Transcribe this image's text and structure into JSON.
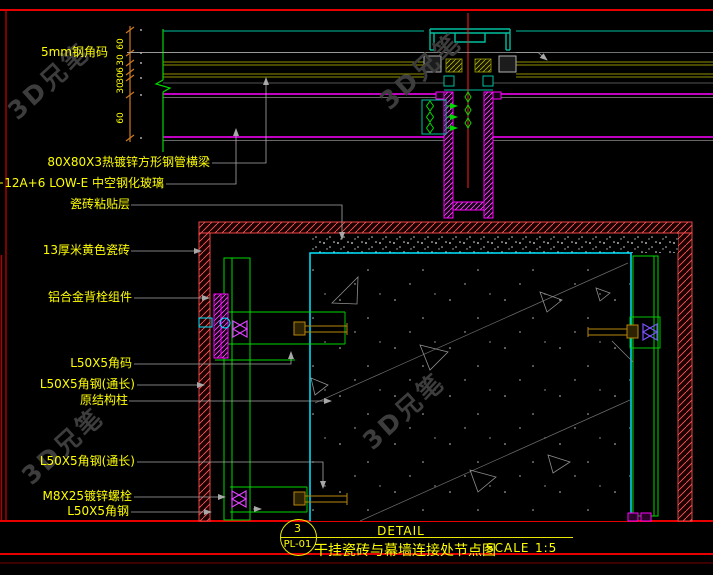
{
  "drawing": {
    "type": "CAD detail drawing",
    "labels": [
      {
        "text": "5mm钢角码"
      },
      {
        "text": "80X80X3热镀锌方形钢管横梁"
      },
      {
        "text": "6+12A+6 LOW-E 中空钢化玻璃"
      },
      {
        "text": "瓷砖粘贴层"
      },
      {
        "text": "13厚米黄色瓷砖"
      },
      {
        "text": "铝合金背栓组件"
      },
      {
        "text": "L50X5角码"
      },
      {
        "text": "L50X5角钢(通长)"
      },
      {
        "text": "原结构柱"
      },
      {
        "text": "L50X5角钢(通长)"
      },
      {
        "text": "M8X25镀锌螺栓"
      },
      {
        "text": "L50X5角钢"
      }
    ],
    "dimensions": {
      "values": [
        "60",
        "30",
        "6",
        "30",
        "30",
        "60"
      ]
    }
  },
  "title_block": {
    "detail_label": "DETAIL",
    "bubble_number": "3",
    "bubble_code": "PL-01",
    "title": "干挂瓷砖与幕墙连接处节点图",
    "scale_label": "SCALE",
    "scale_value": "1:5"
  },
  "watermark": {
    "text": "3D兄笔"
  },
  "colors": {
    "background": "#000000",
    "frame_red": "#e80000",
    "label_yellow": "#ffff00",
    "dimension_orange": "#cf7a1e",
    "steel_green": "#00d900",
    "concrete_cyan": "#00e5ff",
    "mullion_magenta": "#ff00ff",
    "glass_olive": "#8f8f00",
    "tile_red": "#ff5555",
    "leader_grey": "#a8a8a8",
    "cap_teal": "#00bfa0"
  }
}
